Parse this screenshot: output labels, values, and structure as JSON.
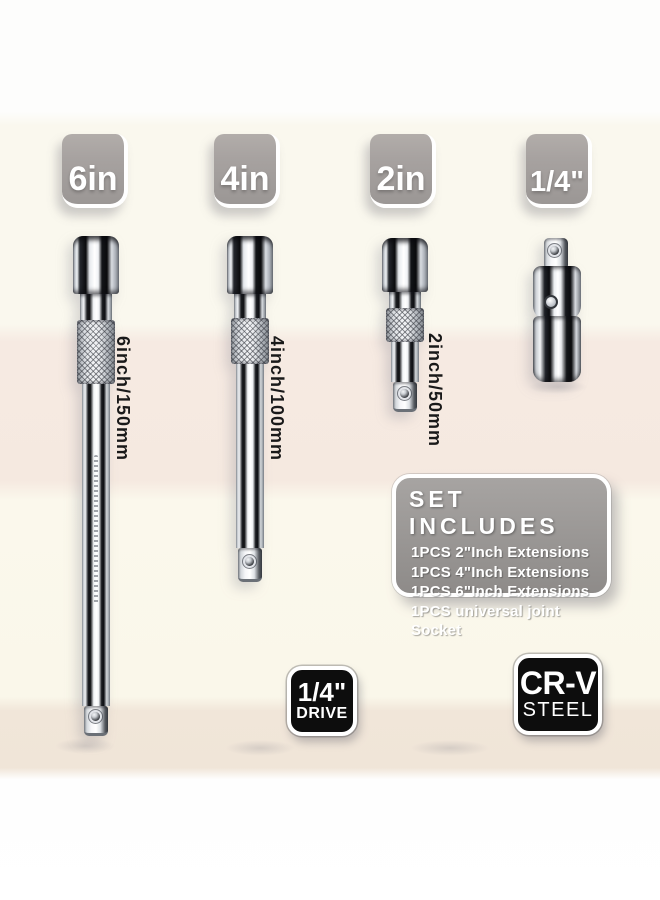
{
  "size_badges": {
    "b6": "6in",
    "b4": "4in",
    "b2": "2in",
    "bq": "1/4\""
  },
  "dimension_labels": {
    "ext6": "6inch/150mm",
    "ext4": "4inch/100mm",
    "ext2": "2inch/50mm"
  },
  "set_includes": {
    "title": "SET INCLUDES",
    "items": [
      "1PCS 2\"Inch Extensions",
      "1PCS 4\"Inch Extensions",
      "1PCS 6\"Inch Extensions",
      "1PCS universal joint Socket"
    ]
  },
  "spec_badges": {
    "drive_size": "1/4\"",
    "drive_label": "DRIVE",
    "material_name": "CR-V",
    "material_label": "STEEL"
  },
  "colors": {
    "size_badge_gray": "#a5a09d",
    "panel_gray": "#9b9795",
    "spec_badge_black": "#0d0d0d",
    "band_cream": "#faf7ec",
    "band_pink": "#f5e9e0",
    "band_beige": "#f0e5d8",
    "label_black": "#191919",
    "text_white": "#ffffff"
  }
}
